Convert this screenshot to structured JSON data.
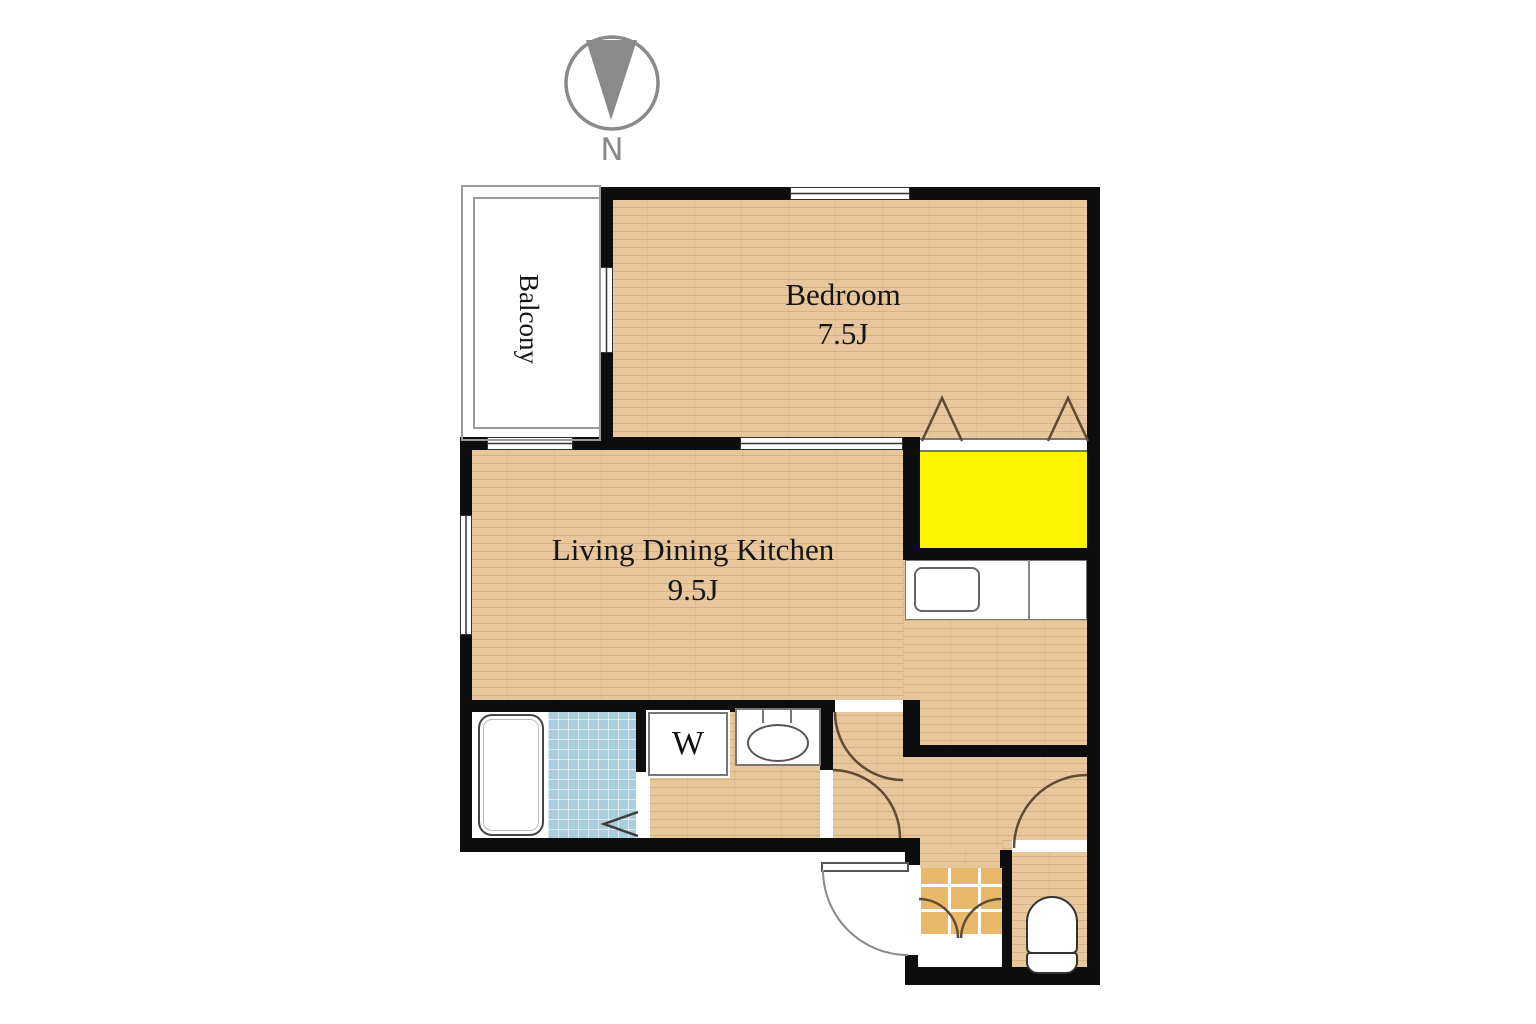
{
  "plan": {
    "compass_label": "N",
    "balcony": {
      "label": "Balcony"
    },
    "bedroom": {
      "name": "Bedroom",
      "size": "7.5J"
    },
    "ldk": {
      "name": "Living Dining Kitchen",
      "size": "9.5J"
    },
    "washer_label": "W"
  },
  "colors": {
    "wall": "#0d0d0d",
    "wood": "#e7c79b",
    "closet-yellow": "#fdf500",
    "bath-blue": "#a9cedd",
    "genkan-tile": "#e8b96a",
    "door-arc": "#5f4a33",
    "compass-gray": "#8a8a8a"
  }
}
